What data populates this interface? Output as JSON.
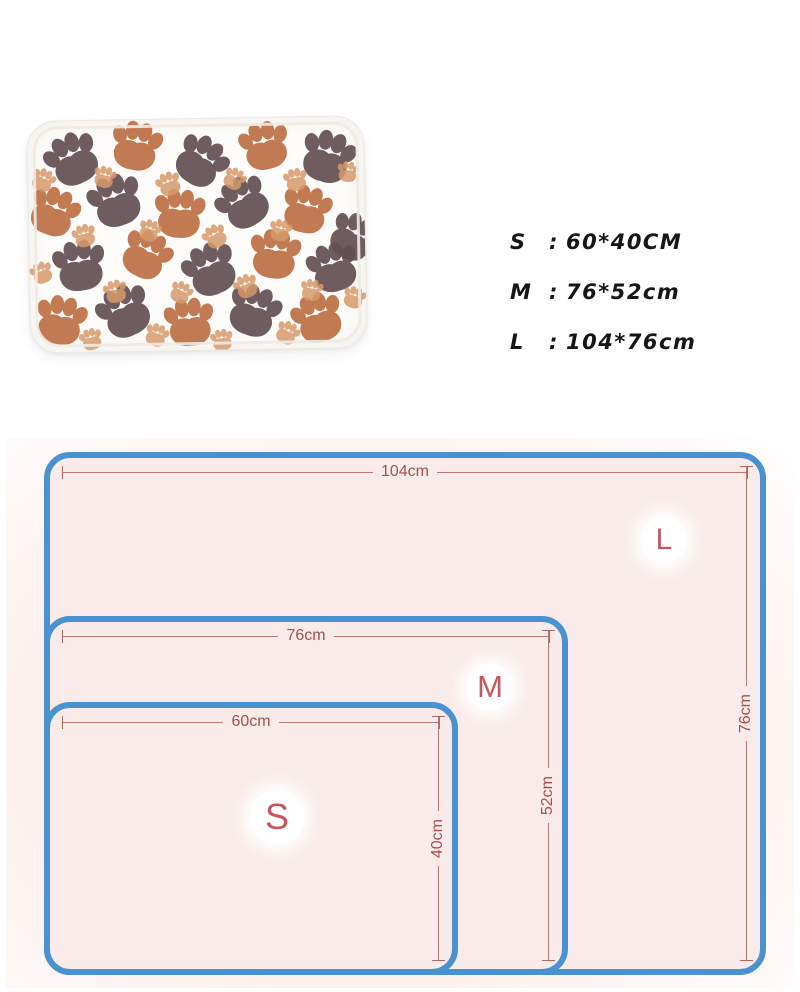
{
  "product_photo": {
    "description": "white fleece pet blanket covered with paw prints",
    "colors": {
      "dark": "#634f53",
      "rust": "#bd6f45",
      "light": "#d6996a"
    },
    "paws": [
      {
        "x": 45,
        "y": 38,
        "r": -25,
        "s": 0.95,
        "c": "dark"
      },
      {
        "x": 108,
        "y": 26,
        "r": 12,
        "s": 0.9,
        "c": "rust"
      },
      {
        "x": 172,
        "y": 42,
        "r": 35,
        "s": 0.92,
        "c": "dark"
      },
      {
        "x": 236,
        "y": 28,
        "r": -12,
        "s": 0.88,
        "c": "rust"
      },
      {
        "x": 298,
        "y": 40,
        "r": 18,
        "s": 0.95,
        "c": "dark"
      },
      {
        "x": 25,
        "y": 90,
        "r": 22,
        "s": 0.88,
        "c": "rust"
      },
      {
        "x": 87,
        "y": 80,
        "r": -18,
        "s": 0.95,
        "c": "dark"
      },
      {
        "x": 150,
        "y": 94,
        "r": 5,
        "s": 0.9,
        "c": "rust"
      },
      {
        "x": 214,
        "y": 84,
        "r": -32,
        "s": 0.93,
        "c": "dark"
      },
      {
        "x": 276,
        "y": 92,
        "r": 15,
        "s": 0.87,
        "c": "rust"
      },
      {
        "x": 322,
        "y": 120,
        "r": 30,
        "s": 0.85,
        "c": "dark"
      },
      {
        "x": 50,
        "y": 144,
        "r": -8,
        "s": 0.93,
        "c": "dark"
      },
      {
        "x": 116,
        "y": 134,
        "r": 28,
        "s": 0.88,
        "c": "rust"
      },
      {
        "x": 180,
        "y": 150,
        "r": -22,
        "s": 0.95,
        "c": "dark"
      },
      {
        "x": 244,
        "y": 136,
        "r": 8,
        "s": 0.9,
        "c": "rust"
      },
      {
        "x": 302,
        "y": 150,
        "r": -15,
        "s": 0.9,
        "c": "dark"
      },
      {
        "x": 30,
        "y": 198,
        "r": 12,
        "s": 0.9,
        "c": "rust"
      },
      {
        "x": 94,
        "y": 190,
        "r": -25,
        "s": 0.95,
        "c": "dark"
      },
      {
        "x": 158,
        "y": 202,
        "r": -5,
        "s": 0.88,
        "c": "rust"
      },
      {
        "x": 222,
        "y": 192,
        "r": 20,
        "s": 0.93,
        "c": "dark"
      },
      {
        "x": 286,
        "y": 200,
        "r": -18,
        "s": 0.9,
        "c": "rust"
      },
      {
        "x": 15,
        "y": 58,
        "r": 25,
        "s": 0.42,
        "c": "light"
      },
      {
        "x": 76,
        "y": 56,
        "r": 15,
        "s": 0.4,
        "c": "light"
      },
      {
        "x": 140,
        "y": 64,
        "r": -20,
        "s": 0.44,
        "c": "light"
      },
      {
        "x": 205,
        "y": 60,
        "r": 30,
        "s": 0.4,
        "c": "light"
      },
      {
        "x": 266,
        "y": 62,
        "r": -10,
        "s": 0.42,
        "c": "light"
      },
      {
        "x": 318,
        "y": 55,
        "r": 8,
        "s": 0.38,
        "c": "light"
      },
      {
        "x": 55,
        "y": 114,
        "r": -15,
        "s": 0.42,
        "c": "light"
      },
      {
        "x": 120,
        "y": 110,
        "r": 20,
        "s": 0.4,
        "c": "light"
      },
      {
        "x": 185,
        "y": 117,
        "r": -28,
        "s": 0.43,
        "c": "light"
      },
      {
        "x": 250,
        "y": 112,
        "r": 12,
        "s": 0.4,
        "c": "light"
      },
      {
        "x": 12,
        "y": 150,
        "r": -20,
        "s": 0.4,
        "c": "light"
      },
      {
        "x": 85,
        "y": 170,
        "r": -12,
        "s": 0.42,
        "c": "light"
      },
      {
        "x": 150,
        "y": 172,
        "r": 25,
        "s": 0.4,
        "c": "light"
      },
      {
        "x": 215,
        "y": 167,
        "r": -22,
        "s": 0.43,
        "c": "light"
      },
      {
        "x": 280,
        "y": 172,
        "r": 10,
        "s": 0.4,
        "c": "light"
      },
      {
        "x": 322,
        "y": 180,
        "r": 18,
        "s": 0.4,
        "c": "light"
      },
      {
        "x": 60,
        "y": 217,
        "r": -15,
        "s": 0.4,
        "c": "light"
      },
      {
        "x": 125,
        "y": 214,
        "r": 20,
        "s": 0.42,
        "c": "light"
      },
      {
        "x": 190,
        "y": 220,
        "r": -8,
        "s": 0.4,
        "c": "light"
      },
      {
        "x": 255,
        "y": 214,
        "r": 28,
        "s": 0.42,
        "c": "light"
      }
    ]
  },
  "size_list": {
    "separator": ":",
    "items": [
      {
        "label": "S",
        "value": "60*40CM"
      },
      {
        "label": "M",
        "value": "76*52cm"
      },
      {
        "label": "L",
        "value": "104*76cm"
      }
    ]
  },
  "diagram": {
    "border_color": "#4a91d0",
    "fill_color": "#f9ebe9",
    "dimension_color": "#a5504f",
    "letter_color": "#c4565e",
    "sizes": [
      {
        "id": "L",
        "width_label": "104cm",
        "height_label": "76cm"
      },
      {
        "id": "M",
        "width_label": "76cm",
        "height_label": "52cm"
      },
      {
        "id": "S",
        "width_label": "60cm",
        "height_label": "40cm"
      }
    ]
  }
}
